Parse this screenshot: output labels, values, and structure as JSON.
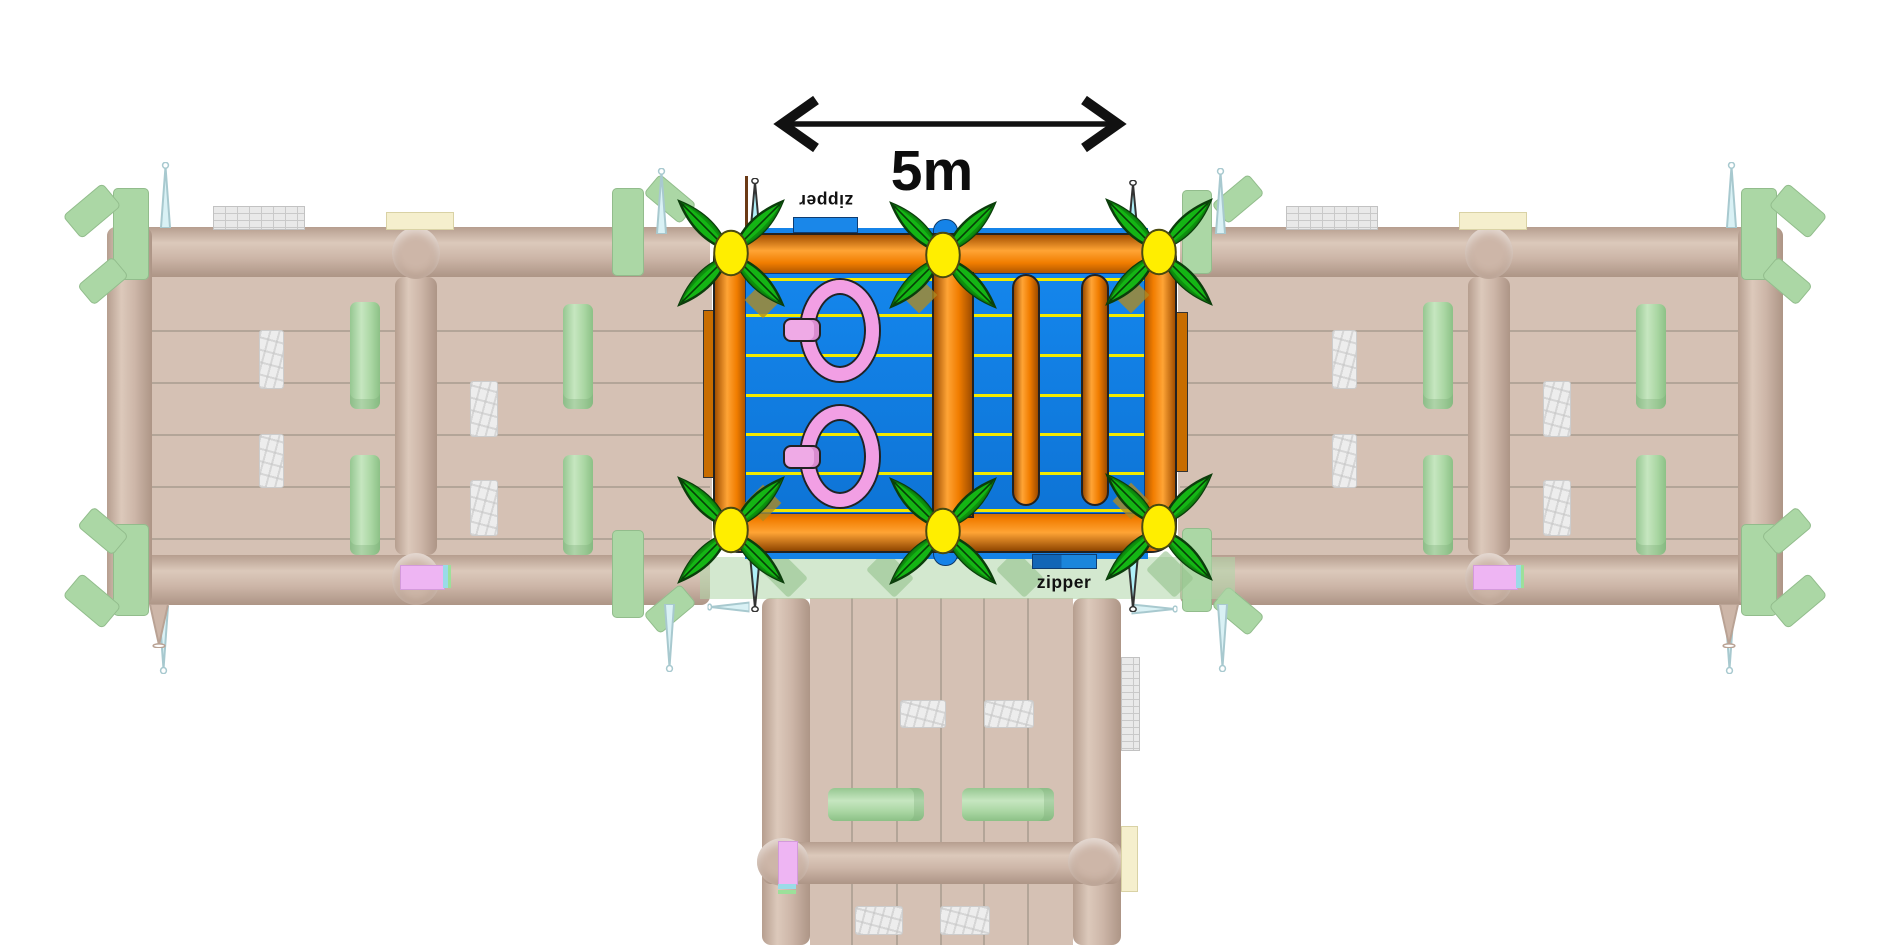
{
  "canvas": {
    "width": 1890,
    "height": 945,
    "background": "#ffffff"
  },
  "dimension_annotation": {
    "label": "5m",
    "color": "#111111"
  },
  "zipper_labels": {
    "top": {
      "text": "zipper",
      "rotated_180": true
    },
    "bottom": {
      "text": "zipper",
      "rotated_180": false
    }
  },
  "palette": {
    "tube_orange": "#ef7b00",
    "floor_blue": "#1084ea",
    "lane_yellow": "#f2ea00",
    "ring_pink": "#f29fe4",
    "flower_leaf_green": "#14b514",
    "flower_center_yellow": "#ffee00",
    "spike_cyan": "#aff0f8",
    "zipper_tab_blue": "#1a87e9",
    "ghost_tan": "#cdb6a8",
    "ghost_green": "#abd7a5",
    "ghost_stone": "#ededed"
  },
  "center_module": {
    "lane_lines_y": [
      4,
      40,
      80,
      120,
      159,
      198,
      235
    ],
    "rings_count": 2,
    "flowers_count": 6,
    "hanging_tubes_count": 2
  },
  "shapes": {
    "ghost_left": [
      {
        "c": "gfloor",
        "x": 152,
        "y": 277,
        "w": 560,
        "h": 278,
        "n": "ghost-left-floor"
      },
      {
        "c": "glane-h",
        "x": 152,
        "y": 330,
        "w": 558,
        "h": 2
      },
      {
        "c": "glane-h",
        "x": 152,
        "y": 382,
        "w": 558,
        "h": 2
      },
      {
        "c": "glane-h",
        "x": 152,
        "y": 434,
        "w": 558,
        "h": 2
      },
      {
        "c": "glane-h",
        "x": 152,
        "y": 486,
        "w": 558,
        "h": 2
      },
      {
        "c": "glane-h",
        "x": 152,
        "y": 538,
        "w": 558,
        "h": 2
      },
      {
        "c": "gtube-h",
        "x": 107,
        "y": 227,
        "w": 603,
        "h": 50,
        "n": "ghost-left-top-tube"
      },
      {
        "c": "gtube-h",
        "x": 107,
        "y": 555,
        "w": 603,
        "h": 50,
        "n": "ghost-left-bottom-tube"
      },
      {
        "c": "gtube-v",
        "x": 107,
        "y": 227,
        "w": 45,
        "h": 378,
        "n": "ghost-left-side-tube"
      },
      {
        "c": "gtube-v",
        "x": 395,
        "y": 277,
        "w": 42,
        "h": 278,
        "n": "ghost-left-divider-tube"
      },
      {
        "c": "gjunction",
        "x": 392,
        "y": 227,
        "w": 48,
        "h": 52
      },
      {
        "c": "gjunction",
        "x": 392,
        "y": 553,
        "w": 48,
        "h": 52
      },
      {
        "c": "gstone",
        "x": 259,
        "y": 330,
        "w": 23,
        "h": 57,
        "n": "stone-obstacle"
      },
      {
        "c": "gstone",
        "x": 259,
        "y": 434,
        "w": 23,
        "h": 52,
        "n": "stone-obstacle"
      },
      {
        "c": "gstone",
        "x": 470,
        "y": 381,
        "w": 26,
        "h": 54,
        "n": "stone-obstacle"
      },
      {
        "c": "gstone",
        "x": 470,
        "y": 480,
        "w": 26,
        "h": 54,
        "n": "stone-obstacle"
      },
      {
        "c": "ggreen",
        "x": 350,
        "y": 302,
        "w": 30,
        "h": 107,
        "n": "green-obstacle"
      },
      {
        "c": "ggreen",
        "x": 350,
        "y": 455,
        "w": 30,
        "h": 100,
        "n": "green-obstacle"
      },
      {
        "c": "ggreen",
        "x": 563,
        "y": 304,
        "w": 30,
        "h": 105,
        "n": "green-obstacle"
      },
      {
        "c": "ggreen",
        "x": 563,
        "y": 455,
        "w": 30,
        "h": 100,
        "n": "green-obstacle"
      },
      {
        "c": "gwall",
        "x": 213,
        "y": 206,
        "w": 90,
        "h": 22,
        "n": "stone-wall-segment"
      },
      {
        "c": "gcream",
        "x": 386,
        "y": 212,
        "w": 66,
        "h": 16,
        "n": "cream-box"
      },
      {
        "c": "gcorner",
        "x": 113,
        "y": 188,
        "w": 36,
        "h": 92
      },
      {
        "c": "gcorner",
        "x": 66,
        "y": 196,
        "w": 52,
        "h": 30,
        "r": -40
      },
      {
        "c": "gcorner",
        "x": 80,
        "y": 268,
        "w": 46,
        "h": 26,
        "r": -40
      },
      {
        "c": "gcorner",
        "x": 113,
        "y": 524,
        "w": 36,
        "h": 92
      },
      {
        "c": "gcorner",
        "x": 66,
        "y": 586,
        "w": 52,
        "h": 30,
        "r": 40
      },
      {
        "c": "gcorner",
        "x": 80,
        "y": 518,
        "w": 46,
        "h": 26,
        "r": 40
      },
      {
        "c": "gcorner",
        "x": 612,
        "y": 188,
        "w": 32,
        "h": 88
      },
      {
        "c": "gcorner",
        "x": 646,
        "y": 186,
        "w": 48,
        "h": 26,
        "r": 40
      },
      {
        "c": "gcorner",
        "x": 612,
        "y": 530,
        "w": 32,
        "h": 88
      },
      {
        "c": "gcorner",
        "x": 646,
        "y": 596,
        "w": 48,
        "h": 26,
        "r": -40
      },
      {
        "c": "gspike",
        "x": 159,
        "y": 162,
        "w": 13,
        "h": 66,
        "n": "tie-down-spike"
      },
      {
        "c": "gspike",
        "x": 655,
        "y": 168,
        "w": 13,
        "h": 66,
        "n": "tie-down-spike"
      },
      {
        "c": "gspike",
        "x": 157,
        "y": 606,
        "w": 13,
        "h": 68,
        "r": 180,
        "n": "tie-down-spike"
      },
      {
        "c": "gspike",
        "x": 663,
        "y": 604,
        "w": 13,
        "h": 68,
        "r": 180,
        "n": "tie-down-spike"
      },
      {
        "c": "gspike-tan",
        "x": 146,
        "y": 604,
        "w": 26,
        "h": 44,
        "r": 180,
        "n": "tie-down-spike"
      },
      {
        "c": "gviolet",
        "x": 400,
        "y": 565,
        "w": 43,
        "h": 23,
        "n": "violet-connector"
      },
      {
        "c": "gcyan-strip",
        "x": 443,
        "y": 565,
        "w": 5,
        "h": 23
      },
      {
        "c": "ggreen-strip",
        "x": 448,
        "y": 565,
        "w": 3,
        "h": 23
      }
    ],
    "ghost_right": [
      {
        "c": "gfloor",
        "x": 1178,
        "y": 277,
        "w": 560,
        "h": 278,
        "n": "ghost-right-floor"
      },
      {
        "c": "glane-h",
        "x": 1180,
        "y": 330,
        "w": 558,
        "h": 2
      },
      {
        "c": "glane-h",
        "x": 1180,
        "y": 382,
        "w": 558,
        "h": 2
      },
      {
        "c": "glane-h",
        "x": 1180,
        "y": 434,
        "w": 558,
        "h": 2
      },
      {
        "c": "glane-h",
        "x": 1180,
        "y": 486,
        "w": 558,
        "h": 2
      },
      {
        "c": "glane-h",
        "x": 1180,
        "y": 538,
        "w": 558,
        "h": 2
      },
      {
        "c": "gtube-h",
        "x": 1180,
        "y": 227,
        "w": 603,
        "h": 50,
        "n": "ghost-right-top-tube"
      },
      {
        "c": "gtube-h",
        "x": 1180,
        "y": 555,
        "w": 603,
        "h": 50,
        "n": "ghost-right-bottom-tube"
      },
      {
        "c": "gtube-v",
        "x": 1738,
        "y": 227,
        "w": 45,
        "h": 378,
        "n": "ghost-right-side-tube"
      },
      {
        "c": "gtube-v",
        "x": 1468,
        "y": 277,
        "w": 42,
        "h": 278,
        "n": "ghost-right-divider-tube"
      },
      {
        "c": "gjunction",
        "x": 1465,
        "y": 227,
        "w": 48,
        "h": 52
      },
      {
        "c": "gjunction",
        "x": 1465,
        "y": 553,
        "w": 48,
        "h": 52
      },
      {
        "c": "gstone",
        "x": 1332,
        "y": 330,
        "w": 23,
        "h": 57,
        "n": "stone-obstacle"
      },
      {
        "c": "gstone",
        "x": 1332,
        "y": 434,
        "w": 23,
        "h": 52,
        "n": "stone-obstacle"
      },
      {
        "c": "gstone",
        "x": 1543,
        "y": 381,
        "w": 26,
        "h": 54,
        "n": "stone-obstacle"
      },
      {
        "c": "gstone",
        "x": 1543,
        "y": 480,
        "w": 26,
        "h": 54,
        "n": "stone-obstacle"
      },
      {
        "c": "ggreen",
        "x": 1423,
        "y": 302,
        "w": 30,
        "h": 107,
        "n": "green-obstacle"
      },
      {
        "c": "ggreen",
        "x": 1423,
        "y": 455,
        "w": 30,
        "h": 100,
        "n": "green-obstacle"
      },
      {
        "c": "ggreen",
        "x": 1636,
        "y": 304,
        "w": 30,
        "h": 105,
        "n": "green-obstacle"
      },
      {
        "c": "ggreen",
        "x": 1636,
        "y": 455,
        "w": 30,
        "h": 100,
        "n": "green-obstacle"
      },
      {
        "c": "gwall",
        "x": 1286,
        "y": 206,
        "w": 90,
        "h": 22,
        "n": "stone-wall-segment"
      },
      {
        "c": "gcream",
        "x": 1459,
        "y": 212,
        "w": 66,
        "h": 16,
        "n": "cream-box"
      },
      {
        "c": "gcorner",
        "x": 1741,
        "y": 188,
        "w": 36,
        "h": 92
      },
      {
        "c": "gcorner",
        "x": 1772,
        "y": 196,
        "w": 52,
        "h": 30,
        "r": 40
      },
      {
        "c": "gcorner",
        "x": 1764,
        "y": 268,
        "w": 46,
        "h": 26,
        "r": 40
      },
      {
        "c": "gcorner",
        "x": 1741,
        "y": 524,
        "w": 36,
        "h": 92
      },
      {
        "c": "gcorner",
        "x": 1772,
        "y": 586,
        "w": 52,
        "h": 30,
        "r": -40
      },
      {
        "c": "gcorner",
        "x": 1764,
        "y": 518,
        "w": 46,
        "h": 26,
        "r": -40
      },
      {
        "c": "gcorner",
        "x": 1182,
        "y": 190,
        "w": 30,
        "h": 84
      },
      {
        "c": "gcorner",
        "x": 1214,
        "y": 186,
        "w": 48,
        "h": 26,
        "r": -40
      },
      {
        "c": "gcorner",
        "x": 1182,
        "y": 528,
        "w": 30,
        "h": 84
      },
      {
        "c": "gcorner",
        "x": 1214,
        "y": 598,
        "w": 48,
        "h": 26,
        "r": 40
      },
      {
        "c": "gspike",
        "x": 1725,
        "y": 162,
        "w": 13,
        "h": 66,
        "n": "tie-down-spike"
      },
      {
        "c": "gspike",
        "x": 1214,
        "y": 168,
        "w": 13,
        "h": 66,
        "n": "tie-down-spike"
      },
      {
        "c": "gspike",
        "x": 1723,
        "y": 606,
        "w": 13,
        "h": 68,
        "r": 180,
        "n": "tie-down-spike"
      },
      {
        "c": "gspike",
        "x": 1216,
        "y": 604,
        "w": 13,
        "h": 68,
        "r": 180,
        "n": "tie-down-spike"
      },
      {
        "c": "gspike-tan",
        "x": 1716,
        "y": 604,
        "w": 26,
        "h": 44,
        "r": 180,
        "n": "tie-down-spike"
      },
      {
        "c": "gviolet",
        "x": 1473,
        "y": 565,
        "w": 43,
        "h": 23,
        "n": "violet-connector"
      },
      {
        "c": "gcyan-strip",
        "x": 1516,
        "y": 565,
        "w": 5,
        "h": 23
      },
      {
        "c": "ggreen-strip",
        "x": 1521,
        "y": 565,
        "w": 3,
        "h": 23
      }
    ],
    "ghost_bottom": [
      {
        "c": "gfloor",
        "x": 810,
        "y": 598,
        "w": 263,
        "h": 347,
        "n": "ghost-bottom-floor"
      },
      {
        "c": "glane-v",
        "x": 851,
        "y": 598,
        "w": 2,
        "h": 347
      },
      {
        "c": "glane-v",
        "x": 896,
        "y": 598,
        "w": 2,
        "h": 347
      },
      {
        "c": "glane-v",
        "x": 940,
        "y": 598,
        "w": 2,
        "h": 347
      },
      {
        "c": "glane-v",
        "x": 983,
        "y": 598,
        "w": 2,
        "h": 347
      },
      {
        "c": "glane-v",
        "x": 1027,
        "y": 598,
        "w": 2,
        "h": 347
      },
      {
        "c": "gtube-v",
        "x": 762,
        "y": 598,
        "w": 48,
        "h": 347,
        "n": "ghost-bottom-left-tube"
      },
      {
        "c": "gtube-v",
        "x": 1073,
        "y": 598,
        "w": 48,
        "h": 347,
        "n": "ghost-bottom-right-tube"
      },
      {
        "c": "gstone",
        "x": 900,
        "y": 700,
        "w": 44,
        "h": 26,
        "n": "stone-obstacle"
      },
      {
        "c": "gstone",
        "x": 984,
        "y": 700,
        "w": 48,
        "h": 26,
        "n": "stone-obstacle"
      },
      {
        "c": "ggreen-h",
        "x": 828,
        "y": 788,
        "w": 96,
        "h": 33,
        "n": "green-obstacle"
      },
      {
        "c": "ggreen-h",
        "x": 962,
        "y": 788,
        "w": 92,
        "h": 33,
        "n": "green-obstacle"
      },
      {
        "c": "gtube-h",
        "x": 762,
        "y": 842,
        "w": 359,
        "h": 42,
        "n": "ghost-bottom-divider-tube"
      },
      {
        "c": "gjunction",
        "x": 757,
        "y": 838,
        "w": 52,
        "h": 48
      },
      {
        "c": "gjunction",
        "x": 1068,
        "y": 838,
        "w": 52,
        "h": 48
      },
      {
        "c": "gstone",
        "x": 855,
        "y": 906,
        "w": 46,
        "h": 27,
        "n": "stone-obstacle"
      },
      {
        "c": "gstone",
        "x": 940,
        "y": 906,
        "w": 48,
        "h": 27,
        "n": "stone-obstacle"
      },
      {
        "c": "gwall-v",
        "x": 1121,
        "y": 657,
        "w": 17,
        "h": 92,
        "n": "stone-wall-segment"
      },
      {
        "c": "gcream",
        "x": 1121,
        "y": 826,
        "w": 15,
        "h": 64,
        "n": "cream-box"
      },
      {
        "c": "gviolet",
        "x": 778,
        "y": 841,
        "w": 18,
        "h": 42,
        "n": "violet-connector"
      },
      {
        "c": "gcyan-strip",
        "x": 778,
        "y": 884,
        "w": 18,
        "h": 5
      },
      {
        "c": "ggreen-strip",
        "x": 778,
        "y": 890,
        "w": 18,
        "h": 4
      },
      {
        "c": "gband",
        "x": 700,
        "y": 557,
        "w": 535,
        "h": 42,
        "n": "ghost-connection-band"
      },
      {
        "c": "gbandpiece",
        "x": 764,
        "y": 560,
        "w": 40,
        "h": 28,
        "r": 45
      },
      {
        "c": "gbandpiece",
        "x": 870,
        "y": 560,
        "w": 40,
        "h": 28,
        "r": 45
      },
      {
        "c": "gbandpiece",
        "x": 1000,
        "y": 560,
        "w": 40,
        "h": 28,
        "r": 45
      },
      {
        "c": "gbandpiece",
        "x": 1150,
        "y": 560,
        "w": 40,
        "h": 28,
        "r": 45
      },
      {
        "c": "gspike",
        "x": 722,
        "y": 586,
        "w": 13,
        "h": 42,
        "r": -90,
        "n": "tie-down-spike"
      },
      {
        "c": "gspike",
        "x": 1148,
        "y": 586,
        "w": 13,
        "h": 46,
        "r": 90,
        "n": "tie-down-spike"
      }
    ],
    "center_under": [
      {
        "c": "cpole",
        "x": 745,
        "y": 176,
        "w": 3,
        "h": 58,
        "n": "anchor-pole"
      },
      {
        "c": "cspike",
        "x": 748,
        "y": 178,
        "w": 14,
        "h": 58,
        "n": "anchor-spike"
      },
      {
        "c": "cspike",
        "x": 1126,
        "y": 180,
        "w": 14,
        "h": 56,
        "n": "anchor-spike"
      },
      {
        "c": "cspike",
        "x": 748,
        "y": 556,
        "w": 14,
        "h": 56,
        "r": 180,
        "n": "anchor-spike"
      },
      {
        "c": "cspike",
        "x": 1126,
        "y": 556,
        "w": 14,
        "h": 56,
        "r": 180,
        "n": "anchor-spike"
      }
    ],
    "center_over": [
      {
        "c": "golive",
        "x": 750,
        "y": 287,
        "w": 26,
        "h": 26,
        "r": 45,
        "n": "anchor-patch"
      },
      {
        "c": "golive",
        "x": 906,
        "y": 282,
        "w": 26,
        "h": 26,
        "r": 45,
        "n": "anchor-patch"
      },
      {
        "c": "golive",
        "x": 1118,
        "y": 282,
        "w": 26,
        "h": 26,
        "r": 45,
        "n": "anchor-patch"
      },
      {
        "c": "golive",
        "x": 750,
        "y": 490,
        "w": 26,
        "h": 26,
        "r": 45,
        "n": "anchor-patch"
      },
      {
        "c": "golive",
        "x": 1118,
        "y": 488,
        "w": 26,
        "h": 26,
        "r": 45,
        "n": "anchor-patch"
      },
      {
        "c": "flower",
        "x": 656,
        "y": 178,
        "w": 150,
        "h": 150,
        "n": "palm-flower-decoration"
      },
      {
        "c": "flower",
        "x": 868,
        "y": 180,
        "w": 150,
        "h": 150,
        "n": "palm-flower-decoration"
      },
      {
        "c": "flower",
        "x": 1084,
        "y": 177,
        "w": 150,
        "h": 150,
        "n": "palm-flower-decoration"
      },
      {
        "c": "flower",
        "x": 656,
        "y": 455,
        "w": 150,
        "h": 150,
        "n": "palm-flower-decoration"
      },
      {
        "c": "flower",
        "x": 868,
        "y": 456,
        "w": 150,
        "h": 150,
        "n": "palm-flower-decoration"
      },
      {
        "c": "flower",
        "x": 1084,
        "y": 452,
        "w": 150,
        "h": 150,
        "n": "palm-flower-decoration"
      }
    ]
  }
}
